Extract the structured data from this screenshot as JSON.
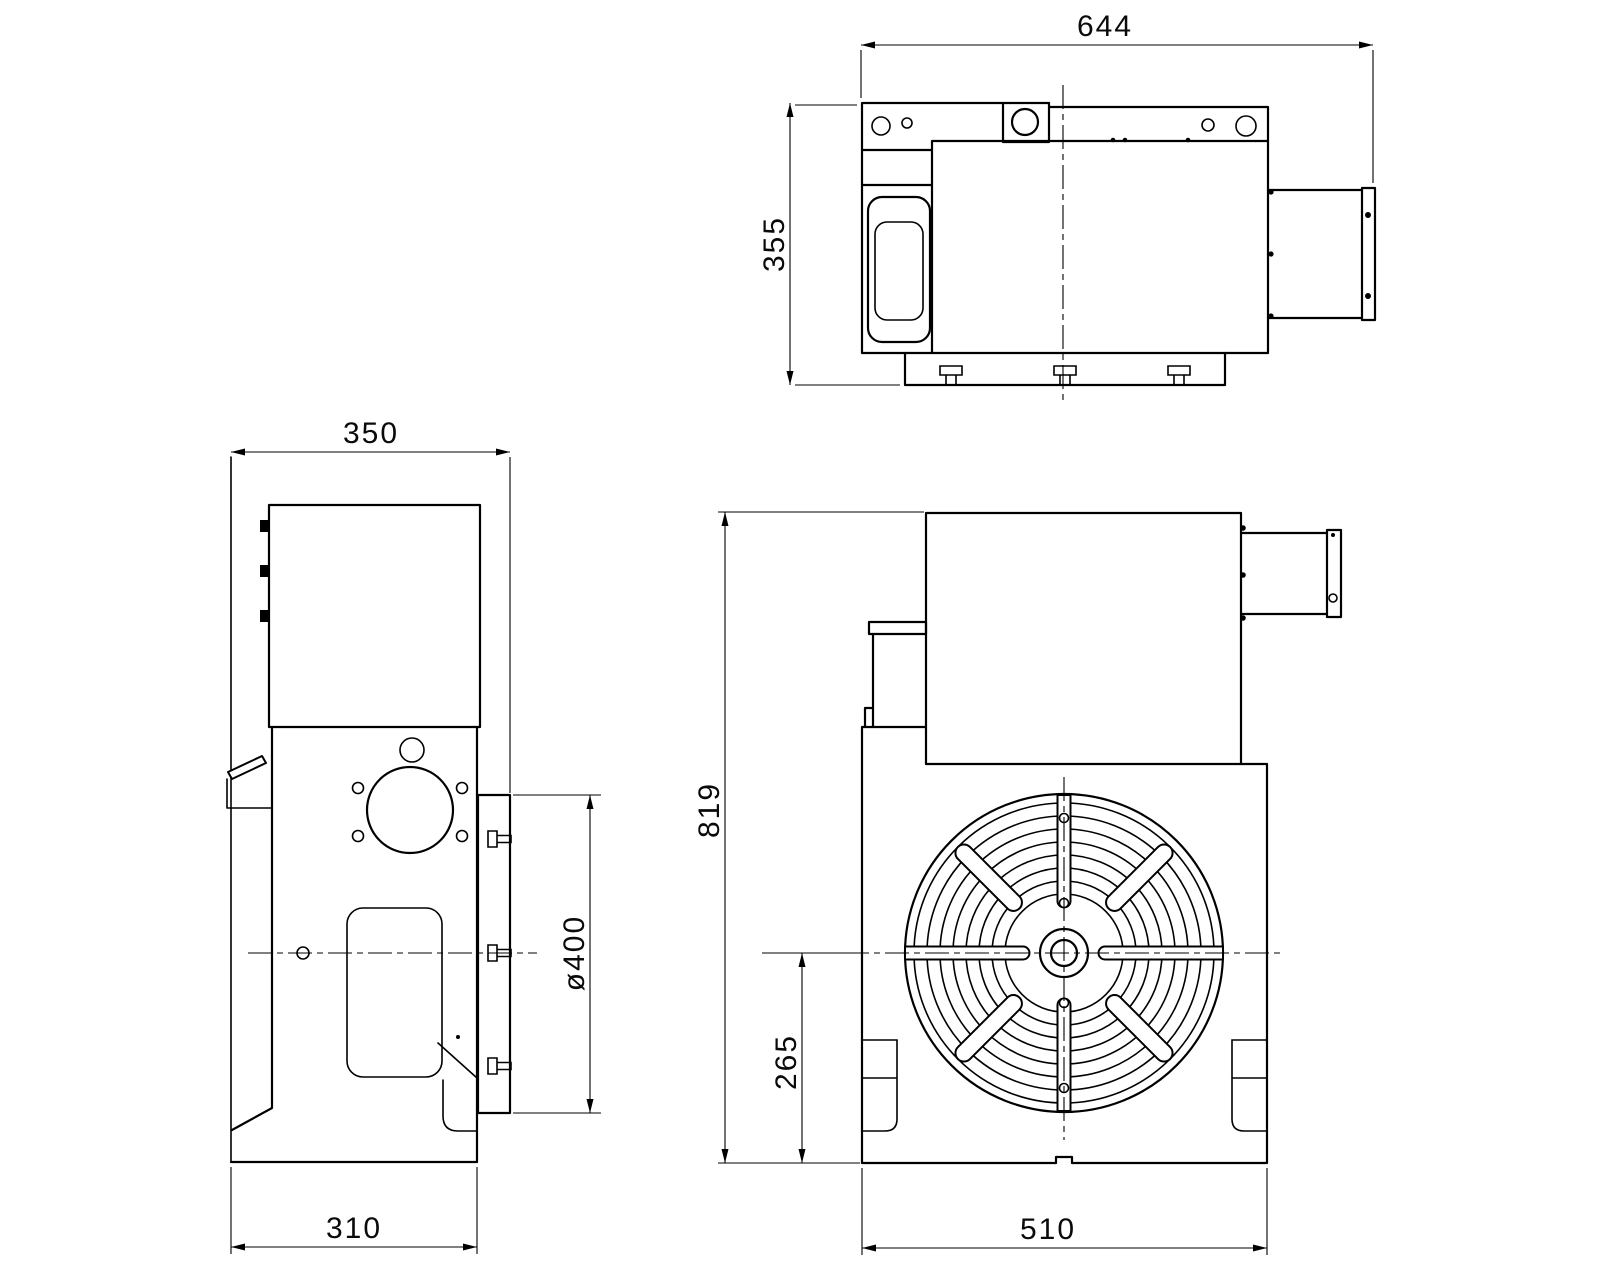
{
  "canvas": {
    "width": 1600,
    "height": 1280,
    "background": "#ffffff",
    "line_color": "#000000"
  },
  "drawing": {
    "kind": "engineering-three-view-drawing",
    "subject": "rotary-table-unit"
  },
  "dimensions": {
    "overall_width": "644",
    "overall_depth": "355",
    "side_top_width": "350",
    "side_base_width": "310",
    "table_diameter": "ø400",
    "overall_height": "819",
    "table_center_height": "265",
    "front_base_width": "510"
  }
}
